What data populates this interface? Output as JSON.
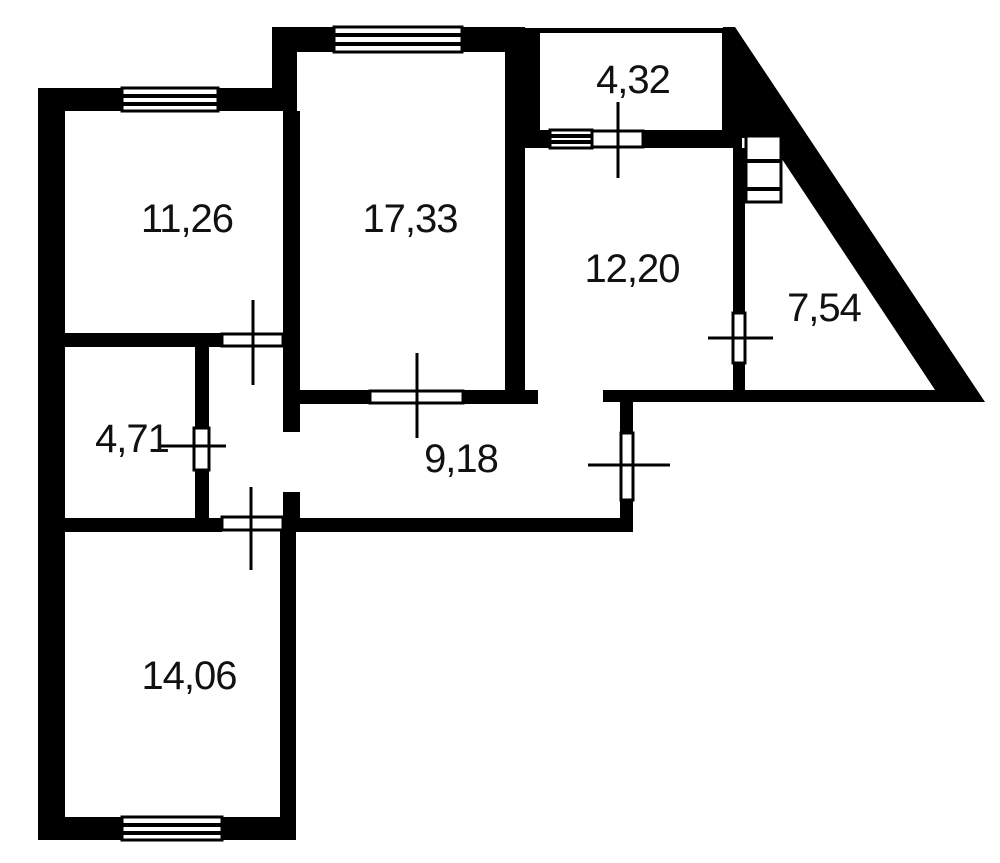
{
  "plan": {
    "type": "apartment-floor-plan",
    "units": "m2",
    "colors": {
      "wall": "#000000",
      "background": "#ffffff",
      "label": "#111111"
    },
    "rooms": [
      {
        "id": "room-top-left",
        "area": "11,26"
      },
      {
        "id": "room-top-middle",
        "area": "17,33"
      },
      {
        "id": "balcony-top-right",
        "area": "4,32"
      },
      {
        "id": "room-right",
        "area": "12,20"
      },
      {
        "id": "balcony-triangular",
        "area": "7,54"
      },
      {
        "id": "room-small-left",
        "area": "4,71"
      },
      {
        "id": "corridor",
        "area": "9,18"
      },
      {
        "id": "room-bottom-left",
        "area": "14,06"
      }
    ]
  }
}
